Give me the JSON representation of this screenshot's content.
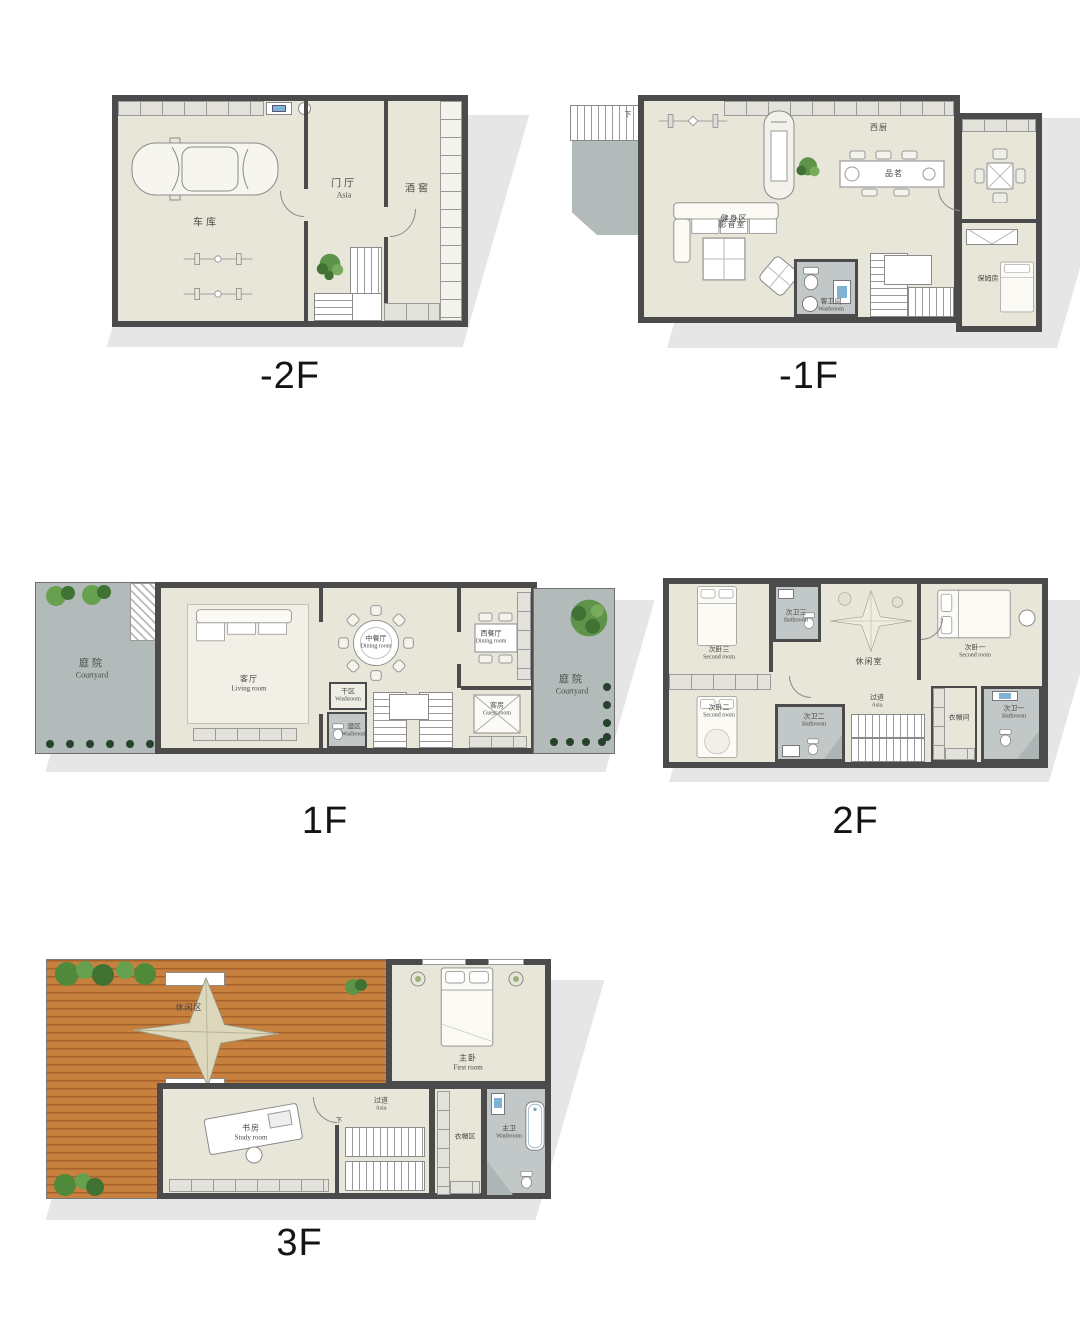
{
  "page": {
    "background": "#ffffff"
  },
  "palette": {
    "wall": "#4b4b4b",
    "floor": "#e8e6d8",
    "courtyard": "#b2bbba",
    "bathroom": "#c2c8c7",
    "deck_wood": "#c8803f",
    "shadow": "#dcdcdc",
    "canopy": "#ddd8bb",
    "plant_green": "#67a04e"
  },
  "floors": [
    {
      "label": "-2F",
      "rooms": {
        "garage": {
          "zh": "车库"
        },
        "foyer": {
          "zh": "门厅",
          "en": "Asia"
        },
        "wine_cellar": {
          "zh": "酒窖"
        }
      }
    },
    {
      "label": "-1F",
      "stair_down": "下",
      "rooms": {
        "gym": {
          "zh": "健身区"
        },
        "west_kitchen": {
          "zh": "西厨"
        },
        "tea_bar": {
          "zh": "品茗"
        },
        "av_room": {
          "zh": "影音室"
        },
        "guest_washroom": {
          "zh": "客卫间",
          "en": "Washroom"
        },
        "nanny_room": {
          "zh": "保姆房"
        }
      }
    },
    {
      "label": "1F",
      "rooms": {
        "courtyard_left": {
          "zh": "庭院",
          "en": "Courtyard"
        },
        "living_room": {
          "zh": "客厅",
          "en": "Living room"
        },
        "chinese_dining": {
          "zh": "中餐厅",
          "en": "Dining room"
        },
        "west_dining": {
          "zh": "西餐厅",
          "en": "Dining room"
        },
        "dry_area": {
          "zh": "干区",
          "en": "Washroom"
        },
        "wet_area": {
          "zh": "湿区",
          "en": "Washroom"
        },
        "guest_room": {
          "zh": "客房",
          "en": "Guest room"
        },
        "courtyard_right": {
          "zh": "庭院",
          "en": "Courtyard"
        }
      }
    },
    {
      "label": "2F",
      "rooms": {
        "bedroom3": {
          "zh": "次卧三",
          "en": "Second room"
        },
        "bath3": {
          "zh": "次卫三",
          "en": "Bathroom"
        },
        "leisure_room": {
          "zh": "休闲室"
        },
        "bedroom1": {
          "zh": "次卧一",
          "en": "Second room"
        },
        "bedroom2": {
          "zh": "次卧二",
          "en": "Second room"
        },
        "bath2": {
          "zh": "次卫二",
          "en": "Bathroom"
        },
        "hallway": {
          "zh": "过道",
          "en": "Asia"
        },
        "closet": {
          "zh": "衣帽间"
        },
        "bath1": {
          "zh": "次卫一",
          "en": "Bathroom"
        }
      }
    },
    {
      "label": "3F",
      "stair_down": "下",
      "rooms": {
        "roof_deck": {
          "zh": "休闲区"
        },
        "master_bedroom": {
          "zh": "主卧",
          "en": "First room"
        },
        "study": {
          "zh": "书房",
          "en": "Study room"
        },
        "hallway": {
          "zh": "过道",
          "en": "Asia"
        },
        "closet_area": {
          "zh": "衣帽区"
        },
        "master_bath": {
          "zh": "主卫",
          "en": "Washroom"
        }
      }
    }
  ]
}
